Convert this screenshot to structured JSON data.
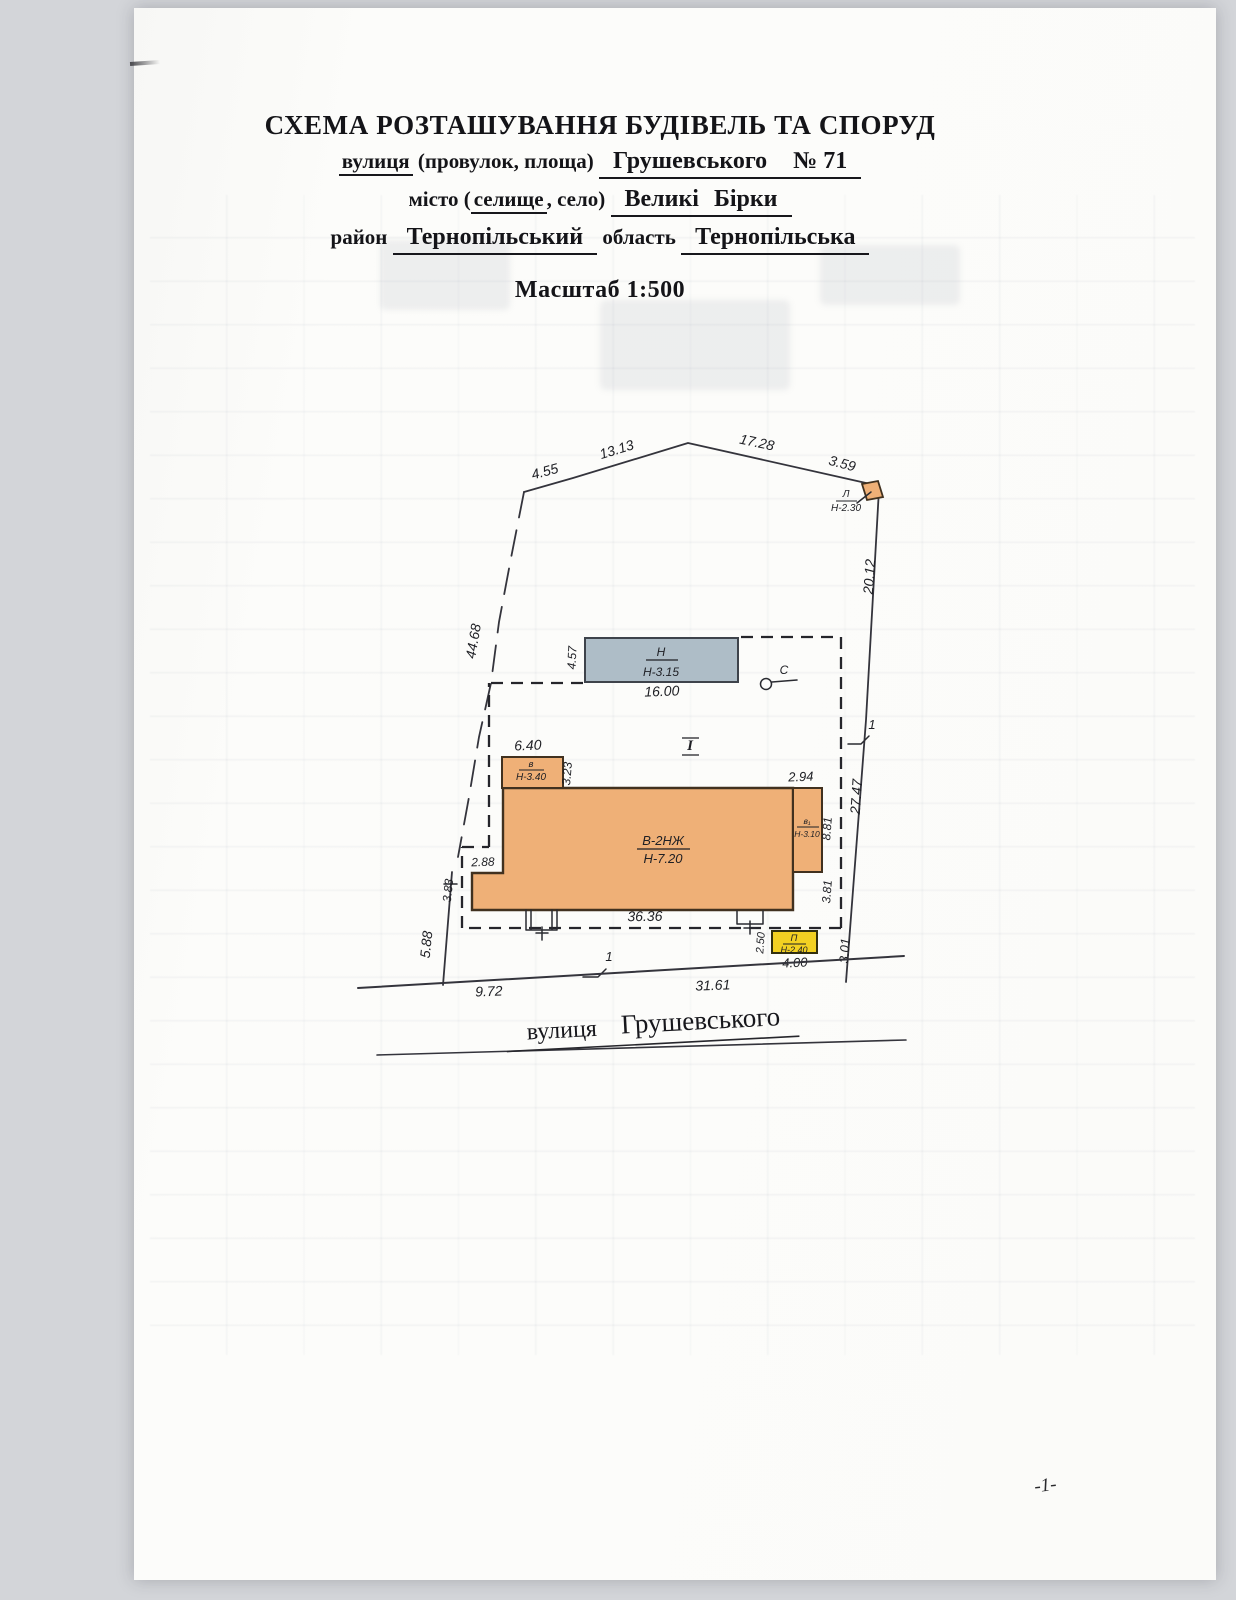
{
  "page": {
    "number": "-1-"
  },
  "header": {
    "title": "СХЕМА РОЗТАШУВАННЯ БУДІВЕЛЬ ТА СПОРУД",
    "street_label": "вулиця",
    "street_label_paren": "(провулок, площа)",
    "street_value": "Грушевського",
    "house_number": "№ 71",
    "city_label_prefix": "місто (",
    "city_label_selected": "селище",
    "city_label_suffix": ", село)",
    "city_value": "Великі Бірки",
    "district_label": "район",
    "district_value": "Тернопільський",
    "region_label": "область",
    "region_value": "Тернопільська",
    "scale": "Масштаб 1:500"
  },
  "plan": {
    "dims": {
      "top1": "4.55",
      "top2": "13.13",
      "top3": "17.28",
      "top4": "3.59",
      "right1": "20.12",
      "right2": "27.47",
      "right3": "3.01",
      "left1": "44.68",
      "left2": "5.88",
      "inner_step": "2.88",
      "inner_left": "3.83",
      "street1": "9.72",
      "street2": "31.61"
    },
    "marks": {
      "plot_number": "І",
      "mark_right": "1",
      "mark_street": "1",
      "well": "С"
    },
    "buildings": {
      "main": {
        "code": "В-2НЖ",
        "height": "Н-7.20",
        "width": "36.36"
      },
      "annex_left": {
        "code": "в",
        "height": "Н-3.40",
        "width": "6.40",
        "depth": "3.23"
      },
      "annex_right": {
        "code": "в₁",
        "height": "Н-3.10",
        "width": "2.94",
        "side_upper": "8.81",
        "side_lower": "3.81"
      },
      "shed": {
        "code": "Н",
        "height": "Н-3.15",
        "depth": "4.57",
        "width": "16.00"
      },
      "gazebo": {
        "code": "Л",
        "height": "Н-2.30"
      },
      "cellar": {
        "code": "П",
        "height": "Н-2.40",
        "depth": "2.50",
        "width": "4.00"
      }
    },
    "street": {
      "prefix": "вулиця",
      "name": "Грушевського"
    }
  },
  "colors": {
    "building_fill": "#efb077",
    "shed_fill": "#aebdc7",
    "cellar_fill": "#f3d122",
    "line": "#34343c"
  }
}
